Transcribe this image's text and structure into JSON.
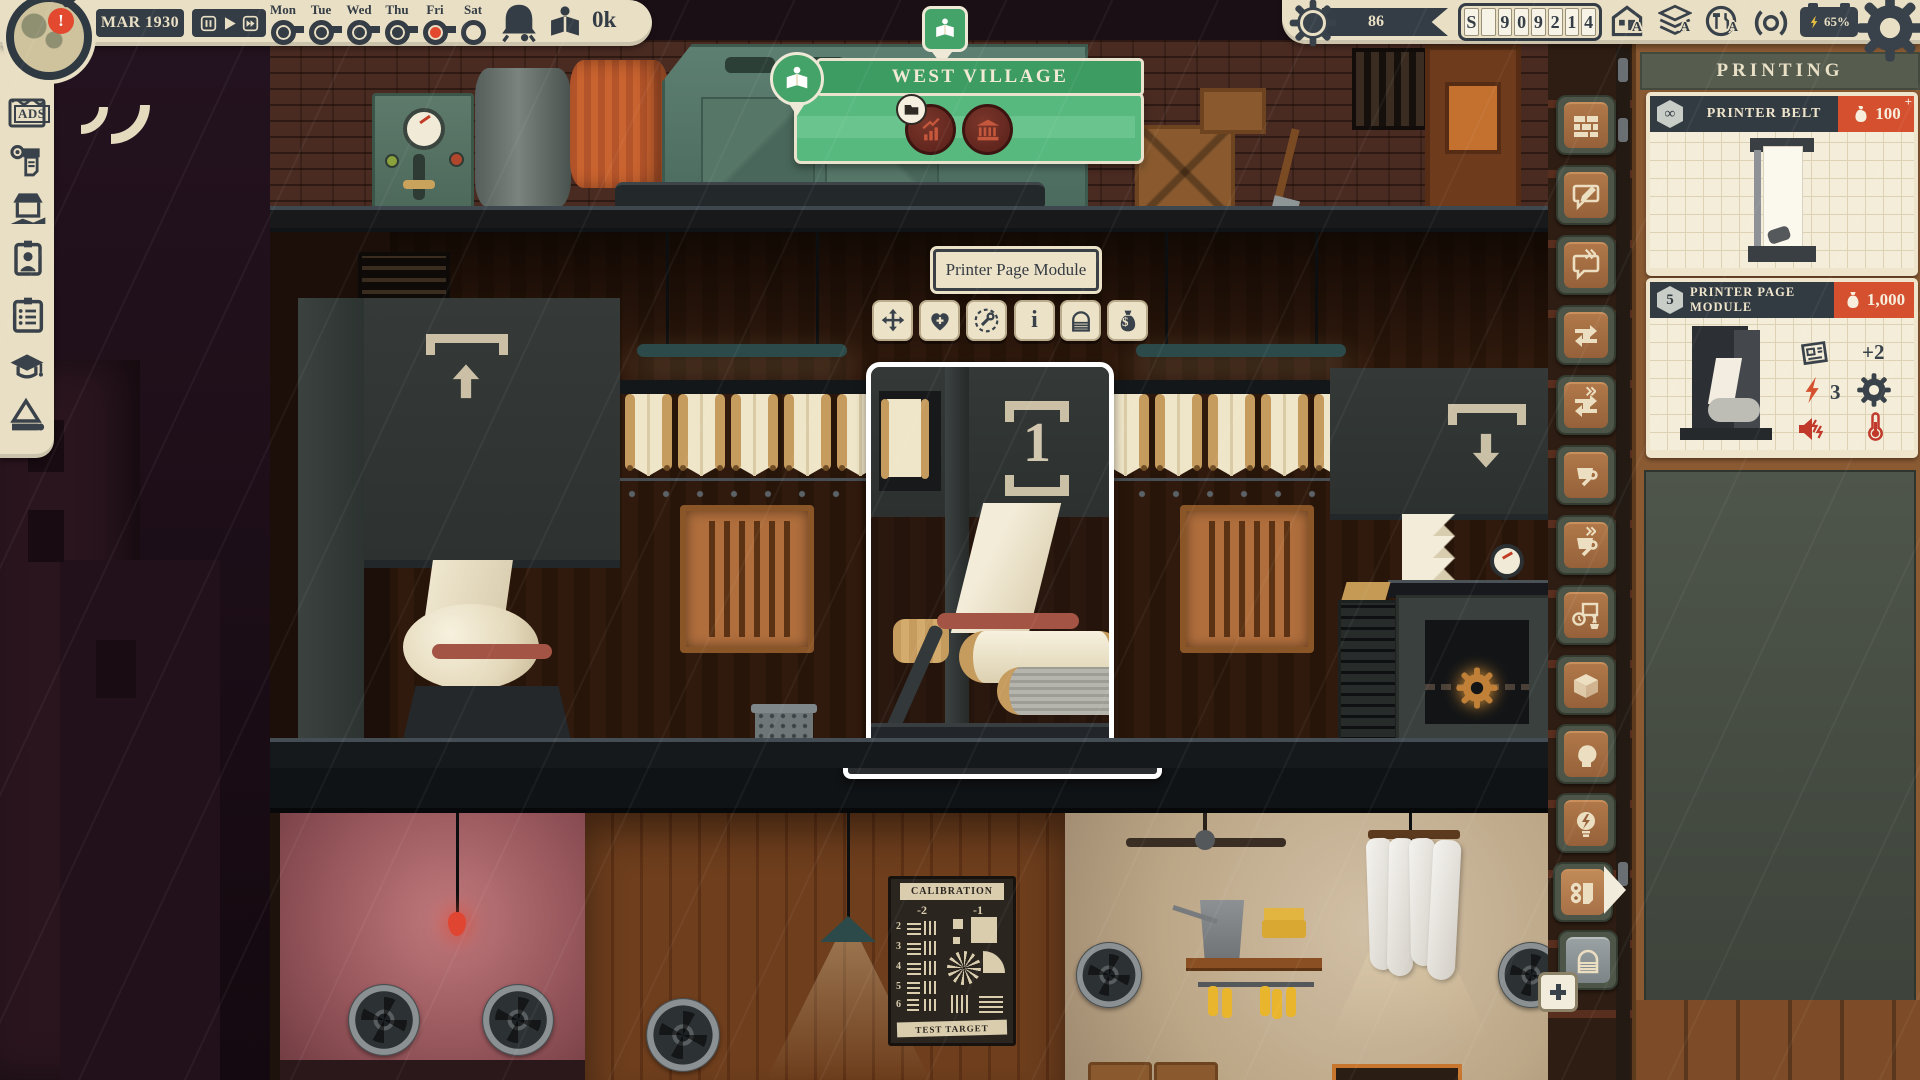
{
  "colors": {
    "ui_cream": "#e9dfc4",
    "ui_dark": "#343d45",
    "accent_red": "#e2492f",
    "banner_green": "#57b97e",
    "price_orange": "#d4502f"
  },
  "top_left_bar": {
    "notification_mark": "!",
    "date": "MAR 1930",
    "days": [
      {
        "label": "Mon",
        "state": "filled"
      },
      {
        "label": "Tue",
        "state": "filled"
      },
      {
        "label": "Wed",
        "state": "filled"
      },
      {
        "label": "Thu",
        "state": "filled"
      },
      {
        "label": "Fri",
        "state": "current"
      },
      {
        "label": "Sat",
        "state": "empty"
      }
    ],
    "money_label": "0k"
  },
  "top_right_bar": {
    "reputation": "86",
    "counter_digits": [
      "S",
      "",
      "9",
      "0",
      "9",
      "2",
      "1",
      "4"
    ],
    "ads_badge": "A",
    "paper_badge": "A",
    "services_badge": "A",
    "battery": "65%"
  },
  "left_toolbar": {
    "ads_label": "ADS"
  },
  "location_banner": {
    "title": "WEST VILLAGE"
  },
  "selection": {
    "tooltip": "Printer Page Module",
    "machine_marker": "1",
    "info_glyph": "i"
  },
  "shop_panel": {
    "title": "PRINTING",
    "currency": "$",
    "items": [
      {
        "name": "PRINTER BELT",
        "stock": "∞",
        "price": "100",
        "price_plus": "+"
      },
      {
        "name": "PRINTER PAGE MODULE",
        "stock": "5",
        "price": "1,000",
        "pages_stat": "+2",
        "power_stat": "3"
      }
    ]
  },
  "calibration_poster": {
    "title": "CALIBRATION",
    "footer": "TEST TARGET",
    "col_labels": [
      "-2",
      "-1"
    ],
    "row_labels": [
      "2",
      "3",
      "4",
      "5",
      "6"
    ]
  }
}
